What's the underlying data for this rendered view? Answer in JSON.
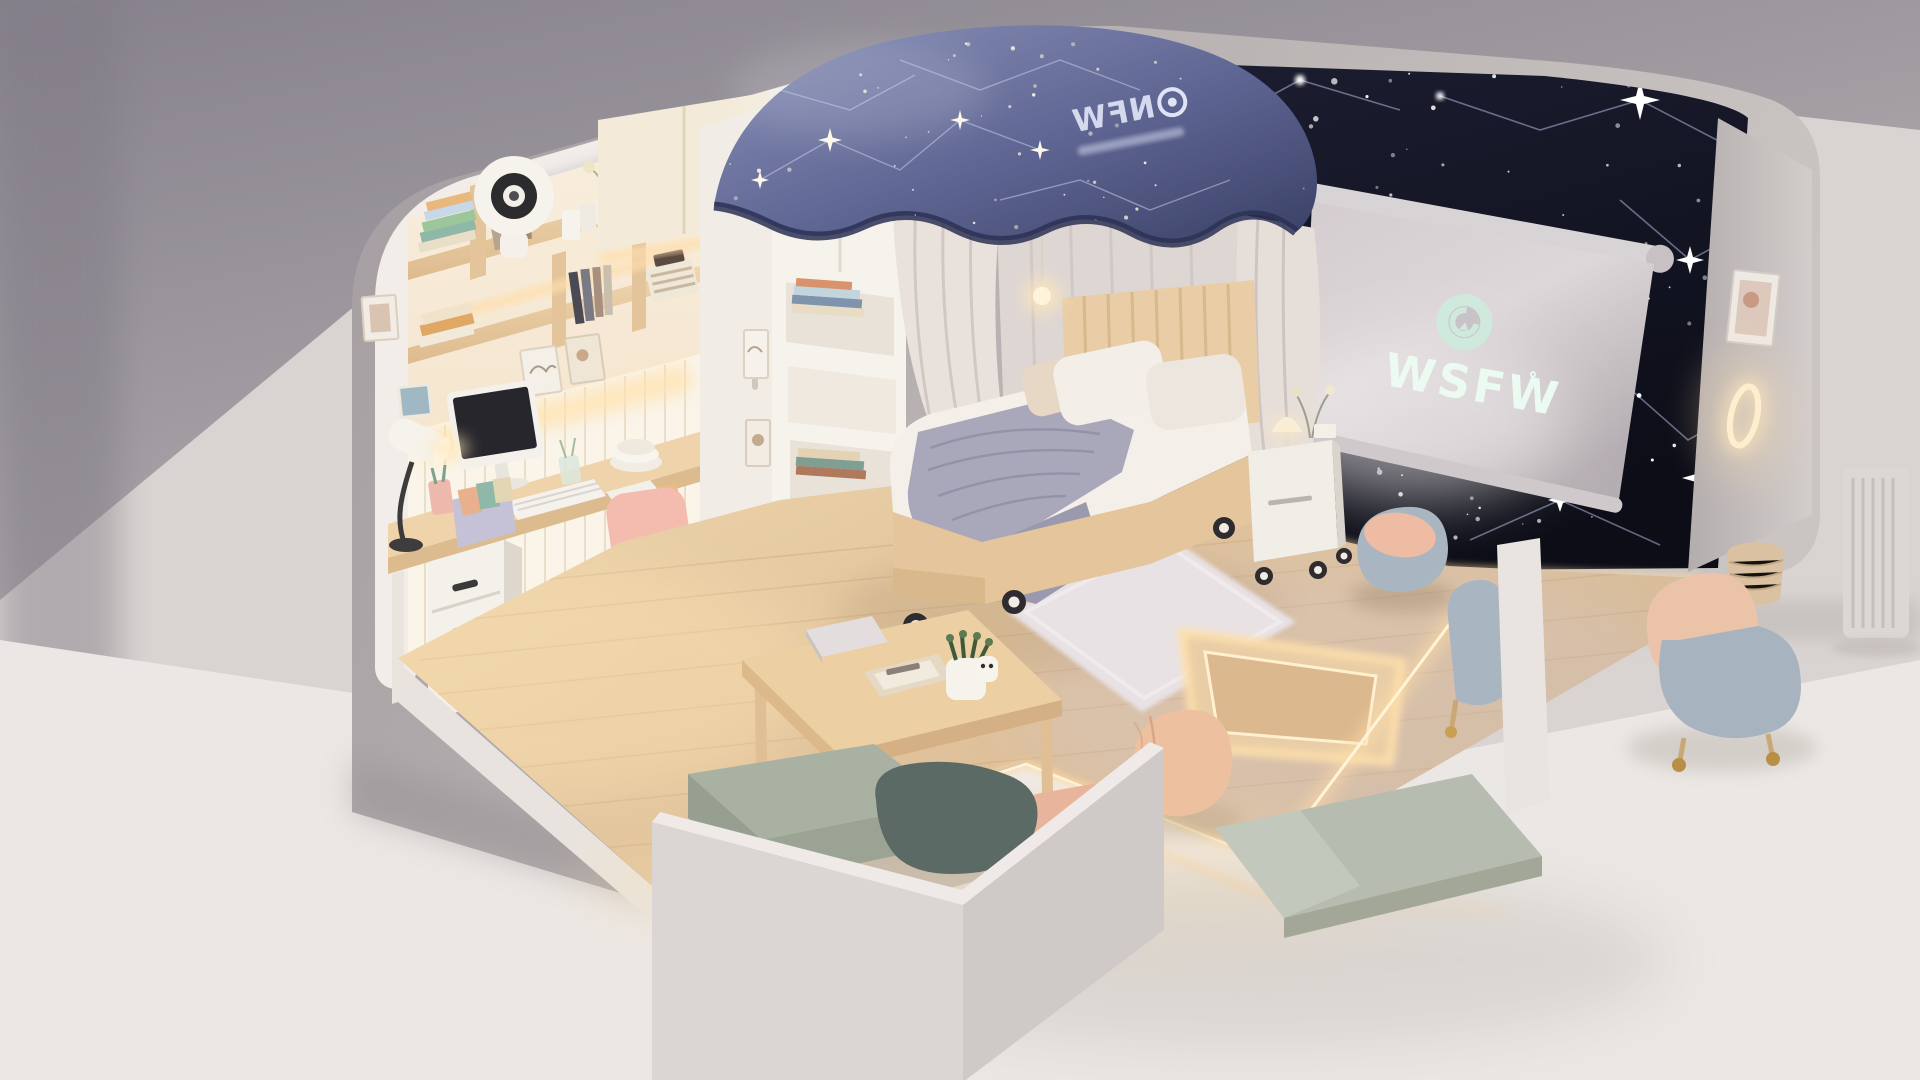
{
  "projector_screen": {
    "logo_text": "WSFW",
    "logo_mark": "˚",
    "icon": "swirl-ring-icon",
    "surface_color": "#d9d3d5",
    "logo_color": "#cfeadd",
    "text_color": "#edfcf4"
  },
  "canopy": {
    "logo_text": "NFW",
    "icon": "target-ring-icon",
    "logo_mirrored": true,
    "fabric_color": "#5e6592",
    "star_color": "#f1e9da"
  },
  "starry_wall": {
    "color": "#14152a",
    "star_color": "#ffffff",
    "constellation_line_color": "#aeb4d8"
  },
  "palette": {
    "outer_shell": "#aba4a6",
    "background_top": "#8b8690",
    "background_floor": "#eae6e3",
    "nook_wall": "#f6e8d6",
    "wood": "#e7cba3",
    "floor_wood": "#e3c8a4",
    "led_glow": "#ffdda6",
    "rug": "#e8e2e5",
    "sofa_cushion": "#a9b2a2",
    "sofa_pillow": "#5c6a66",
    "chair_pink": "#f0b7a6",
    "peach": "#ecc0a4",
    "chair_blue_gray": "#a9b6c2",
    "blanket": "#a9a8bb",
    "curtain": "#e9e1dc"
  },
  "inventory": [
    "study nook with bookshelves and framed prints",
    "ring light device on shelf",
    "desktop monitor with keyboard",
    "desk lamp",
    "pink swivel chair",
    "white drawer unit",
    "white wardrobe with open bookshelf column",
    "canopy bed with starry tent",
    "glowing pendant light",
    "rolling nightstand with lamp and flowers",
    "constellation star wall",
    "projector screen showing WSFW logo",
    "glowing wall ring light",
    "framed picture on outer wall",
    "white radiator",
    "shaggy area rug",
    "LED-lit recessed floor platform",
    "wooden coffee table with notebook, tray and potted plant",
    "peach floor pouf",
    "sage bench cushion",
    "corner sofa with sage cushion and dark pillow",
    "rounded blue-gray armchair with peach cushion",
    "outer armchair with peach cushion and casters",
    "wicker basket"
  ]
}
